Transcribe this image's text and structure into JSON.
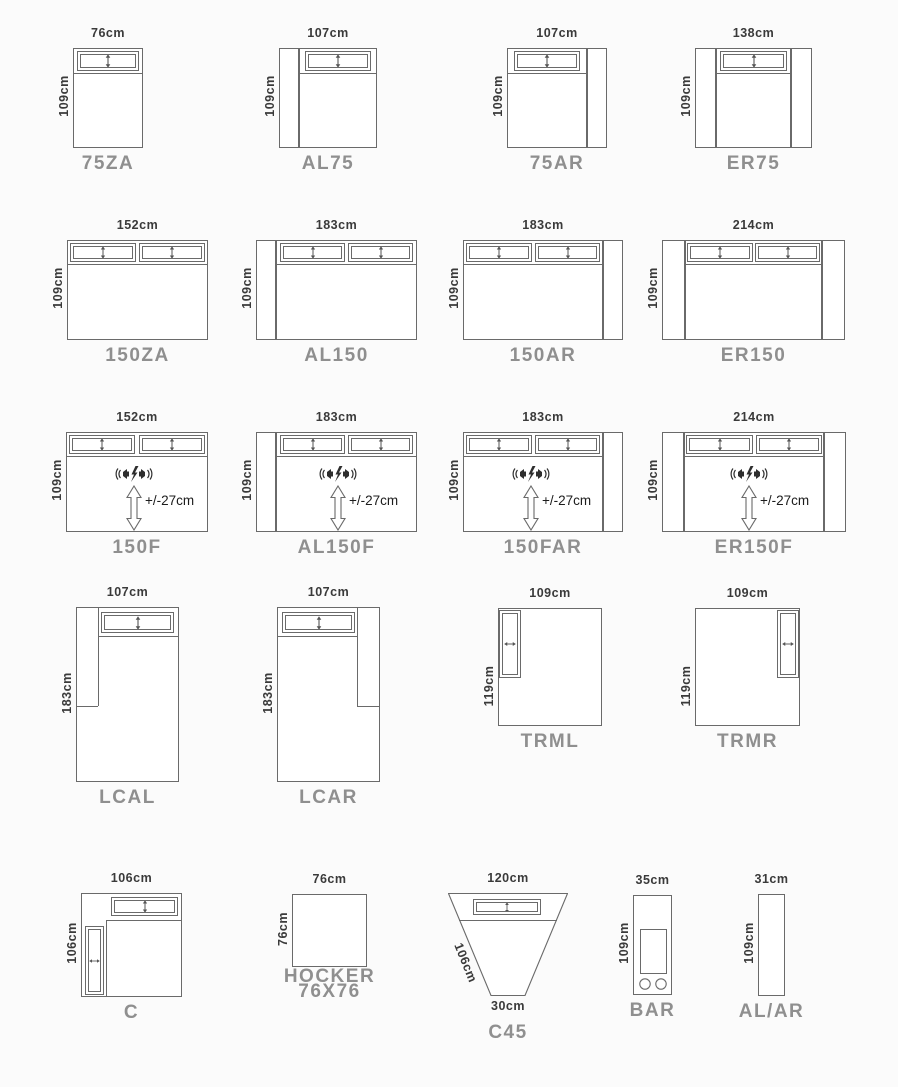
{
  "palette": {
    "background": "#fbfbfb",
    "line": "#6a6a6a",
    "dim_text": "#3a3a3a",
    "label_text": "#8f8f8f",
    "function_text": "#1c1c1c"
  },
  "modules": [
    {
      "id": "75ZA",
      "label": "75ZA",
      "width": "76cm",
      "height": "109cm"
    },
    {
      "id": "AL75",
      "label": "AL75",
      "width": "107cm",
      "height": "109cm"
    },
    {
      "id": "75AR",
      "label": "75AR",
      "width": "107cm",
      "height": "109cm"
    },
    {
      "id": "ER75",
      "label": "ER75",
      "width": "138cm",
      "height": "109cm"
    },
    {
      "id": "150ZA",
      "label": "150ZA",
      "width": "152cm",
      "height": "109cm"
    },
    {
      "id": "AL150",
      "label": "AL150",
      "width": "183cm",
      "height": "109cm"
    },
    {
      "id": "150AR",
      "label": "150AR",
      "width": "183cm",
      "height": "109cm"
    },
    {
      "id": "ER150",
      "label": "ER150",
      "width": "214cm",
      "height": "109cm"
    },
    {
      "id": "150F",
      "label": "150F",
      "width": "152cm",
      "height": "109cm",
      "function": "+/-27cm"
    },
    {
      "id": "AL150F",
      "label": "AL150F",
      "width": "183cm",
      "height": "109cm",
      "function": "+/-27cm"
    },
    {
      "id": "150FAR",
      "label": "150FAR",
      "width": "183cm",
      "height": "109cm",
      "function": "+/-27cm"
    },
    {
      "id": "ER150F",
      "label": "ER150F",
      "width": "214cm",
      "height": "109cm",
      "function": "+/-27cm"
    },
    {
      "id": "LCAL",
      "label": "LCAL",
      "width": "107cm",
      "height": "183cm"
    },
    {
      "id": "LCAR",
      "label": "LCAR",
      "width": "107cm",
      "height": "183cm"
    },
    {
      "id": "TRML",
      "label": "TRML",
      "width": "109cm",
      "height": "119cm"
    },
    {
      "id": "TRMR",
      "label": "TRMR",
      "width": "109cm",
      "height": "119cm"
    },
    {
      "id": "C",
      "label": "C",
      "width": "106cm",
      "height": "106cm"
    },
    {
      "id": "HOCKER",
      "label": "HOCKER",
      "label2": "76X76",
      "width": "76cm",
      "height": "76cm"
    },
    {
      "id": "C45",
      "label": "C45",
      "width": "120cm",
      "height": "106cm",
      "bottom": "30cm"
    },
    {
      "id": "BAR",
      "label": "BAR",
      "width": "35cm",
      "height": "109cm"
    },
    {
      "id": "ALAR",
      "label": "AL/AR",
      "width": "31cm",
      "height": "109cm"
    }
  ]
}
